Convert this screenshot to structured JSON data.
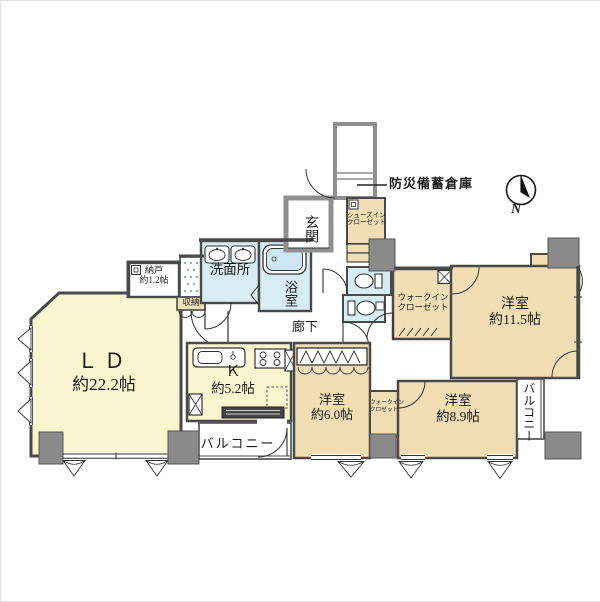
{
  "palette": {
    "room_yellow": "#FAF7D0",
    "room_tan": "#F1DEB5",
    "room_blue": "#D8ECF4",
    "wall_dark": "#4A4A4A",
    "wall_gray": "#8F8F8F",
    "pillar_gray": "#8A8A8A",
    "tub_blue": "#CDE8F4",
    "line": "#333333"
  },
  "compass": {
    "label": "N"
  },
  "annotations": {
    "disaster_storage": "防災備蓄倉庫"
  },
  "rooms": {
    "ld": {
      "name": "ＬＤ",
      "size": "約22.2帖"
    },
    "kitchen": {
      "name": "Ｋ",
      "size": "約5.2帖"
    },
    "bedroom_large": {
      "name": "洋室",
      "size": "約11.5帖"
    },
    "bedroom_medium": {
      "name": "洋室",
      "size": "約8.9帖"
    },
    "bedroom_small": {
      "name": "洋室",
      "size": "約6.0帖"
    },
    "storeroom": {
      "name": "納戸",
      "size": "約1.2帖"
    },
    "washroom": {
      "name": "洗面所"
    },
    "bathroom": {
      "name": "浴室"
    },
    "hallway": {
      "name": "廊下"
    },
    "entrance": {
      "name": "玄関"
    },
    "shoes_closet": {
      "line1": "シューズイン",
      "line2": "クローゼット"
    },
    "walkin_closet_main": {
      "line1": "ウォークイン",
      "line2": "クローゼット"
    },
    "walkin_closet_small": {
      "line1": "ウォークイン",
      "line2": "クロゼット"
    },
    "storage": {
      "name": "収納"
    },
    "balcony_south": {
      "name": "バルコニー"
    },
    "balcony_east": {
      "name": "バルコニー"
    }
  }
}
